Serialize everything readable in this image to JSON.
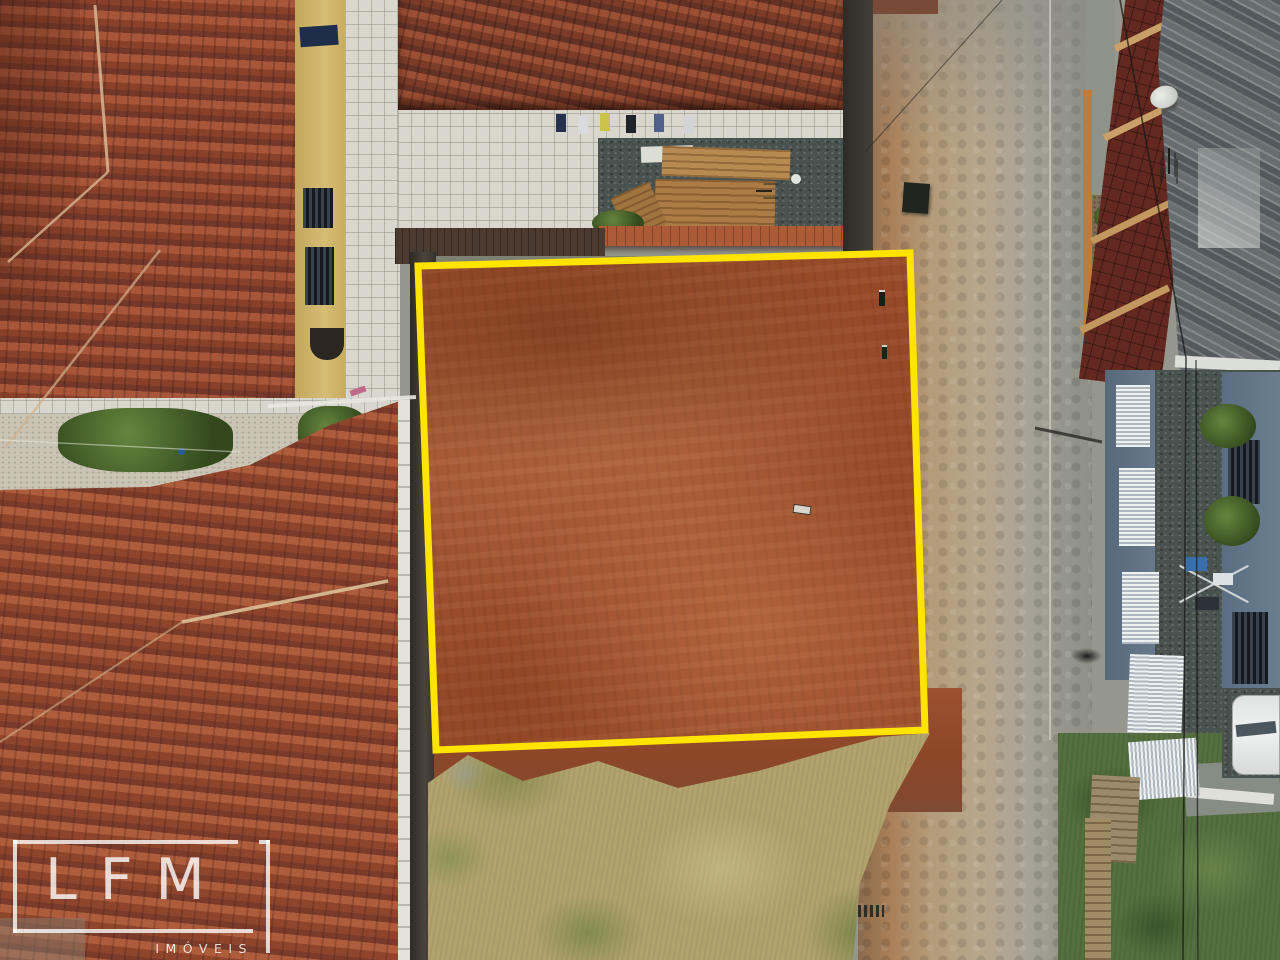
{
  "scene": {
    "type": "aerial-drone-photo",
    "subject": "vacant red-dirt building plot outlined in yellow, surrounded by tiled-roof houses, an unpaved paver street on the right and dry grass below"
  },
  "watermark": {
    "brand": "LFM",
    "subtitle": "IMÓVEIS"
  },
  "palette": {
    "plot_outline": "#FFE400",
    "plot_dirt": "#9C4F2C",
    "roof_tile": "#9A4A2E",
    "dry_grass": "#B2A36E",
    "green_grass": "#55703F",
    "street_pavers": "#B7A78C",
    "street_dirt": "#A87E57",
    "gravel_courtyard": "#48524F",
    "corrugated_roof": "#5C6266",
    "blue_house_wall": "#5F7183",
    "white_car": "#E8EAE9",
    "yellow_house_wall": "#CDB469"
  }
}
